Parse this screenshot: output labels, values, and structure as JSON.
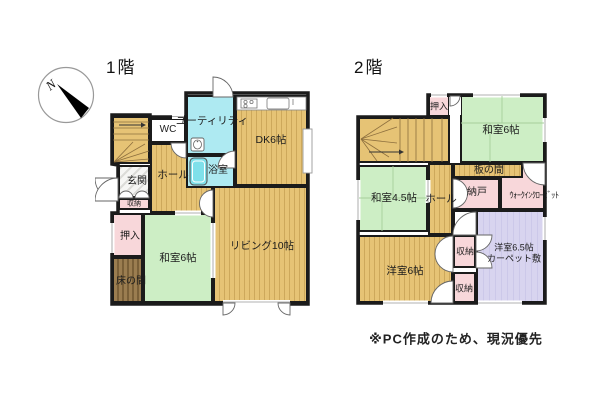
{
  "compass": {
    "north_label": "N"
  },
  "floors": [
    {
      "title": "1階",
      "rooms": {
        "wc": "WC",
        "utility": "ユーティリティ",
        "dk": "DK6帖",
        "bath": "浴室",
        "hall": "ホール",
        "genkan": "玄関",
        "shuno": "収納",
        "oshiire": "押入",
        "washitsu6": "和室6帖",
        "tokonoma": "床の間",
        "living": "リビング10帖"
      }
    },
    {
      "title": "2階",
      "rooms": {
        "oshiire": "押入",
        "washitsu6": "和室6帖",
        "itanoma": "板の間",
        "washitsu45": "和室4.5帖",
        "hall": "ホール",
        "nando": "納戸",
        "wic": "ｳｫｰｸｲﾝｸﾛｰｾﾞｯﾄ",
        "shuno_upper": "収納",
        "shuno_lower": "収納",
        "yoshitsu65": "洋室6.5帖",
        "yoshitsu65_sub": "カーペット敷",
        "yoshitsu6": "洋室6帖"
      }
    }
  ],
  "note": "※PC作成のため、現況優先",
  "colors": {
    "floor_tan": "#e6c375",
    "water_cyan": "#aeeaf2",
    "tatami_green": "#cdeec5",
    "closet_pink": "#f8d7da",
    "carpet_lavender": "#d8d4ef",
    "tokonoma_brown": "#9b7d50",
    "wall_black": "#1b1b1b"
  }
}
